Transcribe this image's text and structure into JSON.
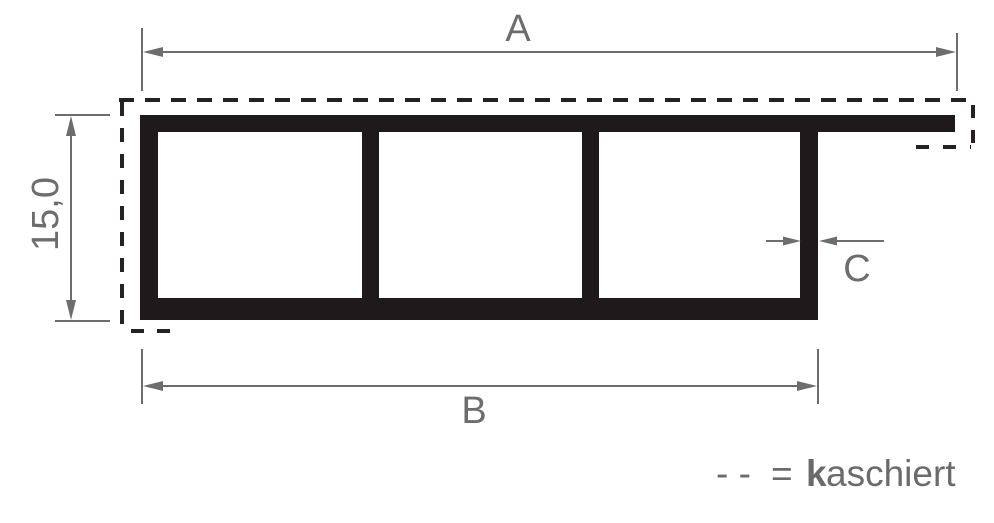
{
  "diagram": {
    "kind": "technical-profile-cross-section-drawing",
    "profile": {
      "chamber_count": 3,
      "has_top_flange_right": true
    },
    "dimension_labels": {
      "overall_width": "A",
      "body_width": "B",
      "height": "15,0",
      "wall_thickness": "C"
    },
    "legend": {
      "dash_symbol": "- -",
      "equals_sign": "=",
      "term_bold": "k",
      "term_rest": "aschiert"
    },
    "colors": {
      "profile_fill": "#1e1a1b",
      "dashed_line": "#262223",
      "dimension_line": "#6d6d6d",
      "label_text": "#6d6d6d",
      "legend_text": "#6b6b6b",
      "background": "#ffffff"
    }
  }
}
